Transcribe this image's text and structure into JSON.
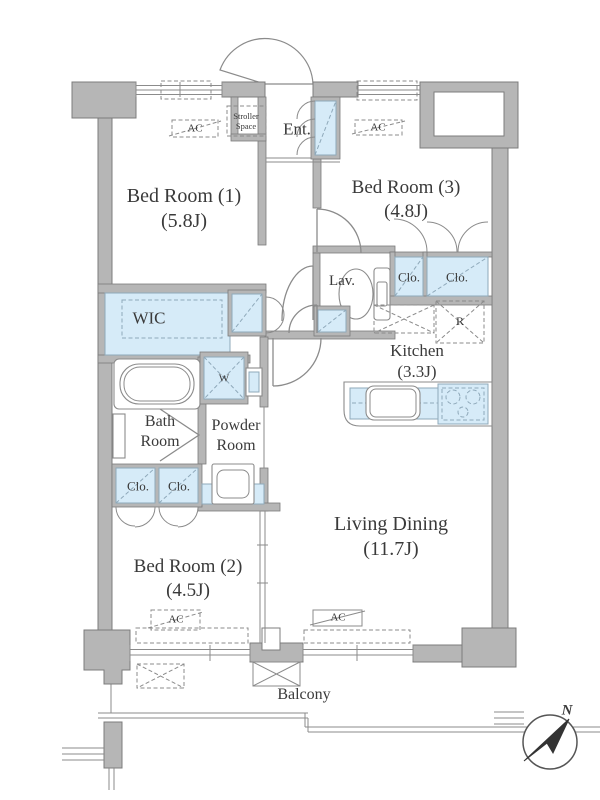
{
  "colors": {
    "wall": "#b6b6b6",
    "wall_stroke": "#7c7c7c",
    "fixture": "#d6ebf8",
    "fixture_stroke": "#8fa9ba",
    "line": "#8b8b8b",
    "text": "#3a3a3a"
  },
  "rooms": {
    "bedroom1": {
      "name": "Bed Room (1)",
      "size": "(5.8J)"
    },
    "bedroom3": {
      "name": "Bed Room (3)",
      "size": "(4.8J)"
    },
    "bedroom2": {
      "name": "Bed Room (2)",
      "size": "(4.5J)"
    },
    "living_dining": {
      "name": "Living Dining",
      "size": "(11.7J)"
    },
    "kitchen": {
      "name": "Kitchen",
      "size": "(3.3J)"
    },
    "wic": {
      "name": "WIC"
    },
    "bath": {
      "name": "Bath Room"
    },
    "powder": {
      "name": "Powder Room"
    },
    "lav": {
      "name": "Lav."
    },
    "entrance": {
      "name": "Ent."
    },
    "stroller_space": {
      "name": "Stroller Space"
    },
    "balcony": {
      "name": "Balcony"
    }
  },
  "labels": {
    "closet": "Clo.",
    "ac_unit": "AC",
    "washing_machine": "W",
    "refrigerator": "R",
    "compass_north": "N"
  }
}
